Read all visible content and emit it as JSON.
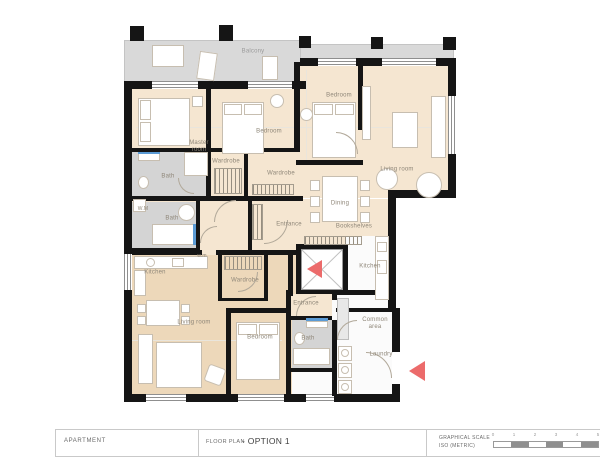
{
  "colors": {
    "wall_black": "#151515",
    "floor_beige": "#f5e6d1",
    "floor_tan": "#edd8ba",
    "balcony_gray": "#d9d9d9",
    "bath_gray": "#d4d4d4",
    "arrow_red": "#ec6b6b",
    "accent_blue": "#5b9bd5"
  },
  "plan": {
    "rooms": {
      "balcony": "Balcony",
      "master": "Master room",
      "bedroom1": "Bedroom",
      "bedroom2": "Bedroom",
      "living1": "Living room",
      "wardrobe1": "Wardrobe",
      "wardrobe2": "Wardrobe",
      "bath1": "Bath",
      "wm1": "W.M",
      "bath2": "Bath",
      "entrance1": "Entrance",
      "dining": "Dining",
      "bookshelves": "Bookshelves",
      "kitchen1": "Kitchen",
      "kitchen2": "Kitchen",
      "wm2": "w.m",
      "wardrobe3": "Wardrobe",
      "living2": "Living room",
      "bedroom3": "Bedroom",
      "entrance2": "Entrance",
      "bath3": "Bath",
      "common": "Common area",
      "laundry": "Laundry"
    }
  },
  "title_block": {
    "project": "APARTMENT",
    "drawing_label": "FLOOR PLAN",
    "drawing_name": "- OPTION 1",
    "scale_label_line1": "GRAPHICAL SCALE",
    "scale_label_line2": "ISO (METRIC)",
    "scale_ticks": [
      "0",
      "1",
      "2",
      "3",
      "4",
      "5"
    ]
  }
}
